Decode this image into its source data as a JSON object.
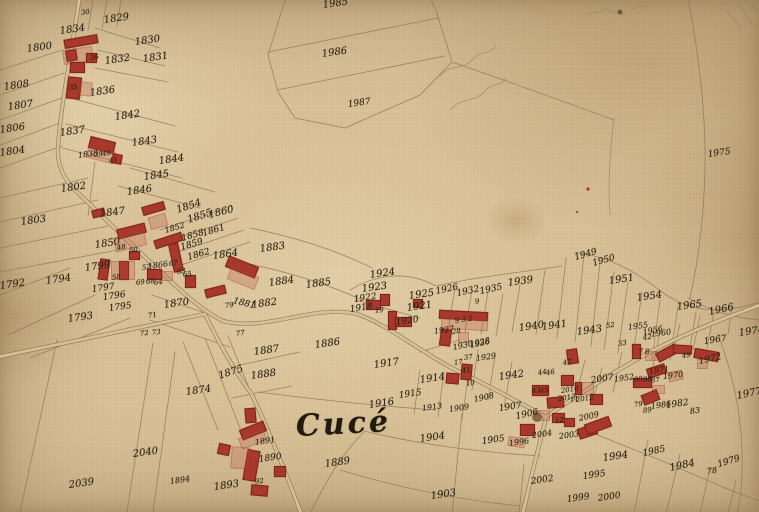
{
  "map": {
    "place_name": "Cucé",
    "colors": {
      "paper": "#d8c096",
      "ink": "#2f2517",
      "building_red": "#a8372c",
      "building_wash": "rgba(186,78,58,0.26)",
      "boundary_line": "#8a7456"
    },
    "labels_format": "text, x, y, fontSizePx(optional, default 10), rotationDeg(optional, default -8)",
    "labels": [
      [
        "1834",
        60,
        27
      ],
      [
        "1829",
        104,
        16
      ],
      [
        "30",
        81,
        10,
        7
      ],
      [
        "1800",
        27,
        45
      ],
      [
        "1830",
        135,
        38
      ],
      [
        "36",
        90,
        55,
        7
      ],
      [
        "1832",
        105,
        57
      ],
      [
        "1831",
        143,
        55
      ],
      [
        "1808",
        4,
        83
      ],
      [
        "35",
        69,
        85,
        7
      ],
      [
        "1836",
        90,
        89
      ],
      [
        "1807",
        8,
        103
      ],
      [
        "1842",
        115,
        113
      ],
      [
        "1806",
        0,
        126
      ],
      [
        "1837",
        60,
        129
      ],
      [
        "1843",
        132,
        139
      ],
      [
        "1804",
        0,
        149
      ],
      [
        "1838",
        78,
        152,
        8
      ],
      [
        "39",
        94,
        152,
        7
      ],
      [
        "40",
        102,
        151,
        7
      ],
      [
        "41",
        109,
        158,
        7
      ],
      [
        "1844",
        159,
        157
      ],
      [
        "1802",
        61,
        185
      ],
      [
        "1845",
        144,
        173
      ],
      [
        "1846",
        127,
        188
      ],
      [
        "1803",
        21,
        218
      ],
      [
        "1847",
        100,
        210
      ],
      [
        "1854",
        177,
        206,
        10,
        -18
      ],
      [
        "1855",
        188,
        216,
        10,
        -18
      ],
      [
        "1860",
        209,
        211,
        10,
        -14
      ],
      [
        "1852",
        165,
        227,
        8,
        -16
      ],
      [
        "1858",
        182,
        235,
        9,
        -16
      ],
      [
        "1861",
        203,
        230,
        9,
        -16
      ],
      [
        "1850",
        95,
        241
      ],
      [
        "1859",
        181,
        244,
        9,
        -16
      ],
      [
        "1862",
        188,
        254,
        9,
        -16
      ],
      [
        "1864",
        213,
        252
      ],
      [
        "48",
        117,
        245,
        7
      ],
      [
        "50",
        129,
        248,
        7
      ],
      [
        "52",
        142,
        265,
        7
      ],
      [
        "1866",
        148,
        263,
        8
      ],
      [
        "67",
        169,
        261,
        7
      ],
      [
        "63",
        177,
        269,
        7
      ],
      [
        "65",
        183,
        272,
        7
      ],
      [
        "58",
        112,
        275,
        7
      ],
      [
        "69",
        136,
        280,
        7
      ],
      [
        "68",
        146,
        279,
        7
      ],
      [
        "64",
        154,
        280,
        7
      ],
      [
        "1799",
        85,
        264
      ],
      [
        "1792",
        0,
        282
      ],
      [
        "1794",
        46,
        277
      ],
      [
        "1797",
        92,
        286,
        9
      ],
      [
        "1796",
        103,
        294,
        9
      ],
      [
        "1795",
        109,
        305,
        9
      ],
      [
        "1793",
        68,
        315
      ],
      [
        "1870",
        164,
        301
      ],
      [
        "79",
        225,
        303,
        7
      ],
      [
        "1881",
        233,
        297,
        9,
        14
      ],
      [
        "71",
        148,
        313,
        7
      ],
      [
        "72",
        140,
        331,
        7
      ],
      [
        "73",
        152,
        330,
        7
      ],
      [
        "77",
        236,
        331,
        7
      ],
      [
        "1985",
        323,
        1
      ],
      [
        "1986",
        322,
        50
      ],
      [
        "1987",
        348,
        101,
        9
      ],
      [
        "1975",
        708,
        151,
        9
      ],
      [
        "1883",
        260,
        245
      ],
      [
        "1884",
        269,
        279
      ],
      [
        "1885",
        306,
        281
      ],
      [
        "1882",
        252,
        301
      ],
      [
        "1924",
        370,
        271
      ],
      [
        "1923",
        362,
        285
      ],
      [
        "1922",
        354,
        296,
        9
      ],
      [
        "1925",
        409,
        292
      ],
      [
        "1918",
        350,
        306,
        9
      ],
      [
        "19",
        375,
        308,
        7
      ],
      [
        "1921",
        407,
        304
      ],
      [
        "1920",
        396,
        319,
        9
      ],
      [
        "1926",
        436,
        288,
        9,
        -12
      ],
      [
        "1932",
        457,
        290,
        9,
        -12
      ],
      [
        "9",
        475,
        299,
        7
      ],
      [
        "1935",
        480,
        288,
        9,
        -12
      ],
      [
        "9 3 2",
        455,
        318,
        7
      ],
      [
        "1927",
        434,
        328,
        8
      ],
      [
        "28",
        452,
        329,
        7
      ],
      [
        "1930",
        453,
        344,
        8,
        -12
      ],
      [
        "1936",
        470,
        342,
        8,
        -12
      ],
      [
        "37",
        464,
        355,
        7
      ],
      [
        "1929",
        476,
        355,
        8
      ],
      [
        "17",
        454,
        360,
        7
      ],
      [
        "41",
        462,
        368,
        7
      ],
      [
        "10",
        466,
        381,
        7
      ],
      [
        "1939",
        508,
        279
      ],
      [
        "1949",
        575,
        254,
        9,
        -16
      ],
      [
        "1950",
        593,
        260,
        9,
        -16
      ],
      [
        "1951",
        609,
        277
      ],
      [
        "1954",
        637,
        294
      ],
      [
        "1965",
        677,
        303
      ],
      [
        "1966",
        709,
        308,
        10,
        -12
      ],
      [
        "1940",
        519,
        324
      ],
      [
        "1941",
        542,
        323
      ],
      [
        "1943",
        577,
        328
      ],
      [
        "52",
        606,
        323,
        7
      ],
      [
        "33",
        618,
        341,
        7
      ],
      [
        "1955",
        628,
        324,
        8
      ],
      [
        "1956",
        643,
        329,
        8,
        -12
      ],
      [
        "42",
        643,
        335,
        7
      ],
      [
        "1960",
        651,
        331,
        8
      ],
      [
        "1974",
        739,
        329
      ],
      [
        "1977",
        737,
        392,
        10,
        -12
      ],
      [
        "1967",
        704,
        338,
        9
      ],
      [
        "1972",
        699,
        358,
        9,
        -12
      ],
      [
        "1971",
        649,
        368,
        8
      ],
      [
        "1970",
        663,
        373,
        8,
        -6
      ],
      [
        "7",
        639,
        349,
        7
      ],
      [
        "8",
        645,
        349,
        7
      ],
      [
        "49",
        682,
        353,
        7
      ],
      [
        "1952",
        614,
        376,
        8
      ],
      [
        "90",
        634,
        377,
        7
      ],
      [
        "88",
        643,
        377,
        7
      ],
      [
        "87",
        651,
        378,
        7
      ],
      [
        "79",
        634,
        402,
        7
      ],
      [
        "89",
        643,
        408,
        7
      ],
      [
        "1986",
        651,
        403,
        8
      ],
      [
        "1982",
        666,
        402,
        9
      ],
      [
        "83",
        690,
        408,
        8
      ],
      [
        "78",
        707,
        468,
        8
      ],
      [
        "1979",
        718,
        461,
        9,
        -16
      ],
      [
        "1984",
        670,
        464,
        10,
        -12
      ],
      [
        "1985",
        643,
        450,
        9,
        -12
      ],
      [
        "1942",
        499,
        373
      ],
      [
        "44",
        538,
        370,
        7
      ],
      [
        "46",
        546,
        370,
        7
      ],
      [
        "47",
        563,
        360,
        7
      ],
      [
        "43",
        532,
        388,
        7
      ],
      [
        "45",
        540,
        388,
        7
      ],
      [
        "2010",
        561,
        388,
        7
      ],
      [
        "2013",
        558,
        396,
        7
      ],
      [
        "11",
        570,
        397,
        7
      ],
      [
        "2012",
        576,
        397,
        7
      ],
      [
        "2007",
        591,
        377,
        9
      ],
      [
        "2009",
        579,
        415,
        8,
        -12
      ],
      [
        "1907",
        499,
        405,
        9
      ],
      [
        "1906",
        516,
        413,
        9,
        -12
      ],
      [
        "12",
        555,
        418,
        7
      ],
      [
        "2004",
        532,
        432,
        8
      ],
      [
        "2003",
        559,
        433,
        8
      ],
      [
        "2002",
        531,
        478,
        9
      ],
      [
        "1996",
        509,
        440,
        8
      ],
      [
        "1917",
        374,
        361
      ],
      [
        "1914",
        420,
        376
      ],
      [
        "1915",
        399,
        392,
        9
      ],
      [
        "1916",
        369,
        401
      ],
      [
        "1913",
        422,
        405,
        8
      ],
      [
        "1909",
        449,
        406,
        8
      ],
      [
        "1908",
        474,
        396,
        8,
        -12
      ],
      [
        "1904",
        420,
        435
      ],
      [
        "1905",
        482,
        438,
        9
      ],
      [
        "1903",
        431,
        492
      ],
      [
        "1886",
        315,
        341
      ],
      [
        "1887",
        254,
        348
      ],
      [
        "1888",
        251,
        372
      ],
      [
        "1889",
        325,
        460
      ],
      [
        "1891",
        255,
        439,
        8
      ],
      [
        "1890",
        259,
        456,
        9
      ],
      [
        "92",
        255,
        479,
        7
      ],
      [
        "1893",
        214,
        483
      ],
      [
        "1894",
        170,
        478,
        8
      ],
      [
        "2040",
        133,
        450
      ],
      [
        "2039",
        69,
        481
      ],
      [
        "1874",
        186,
        388
      ],
      [
        "1875",
        219,
        372,
        10,
        -18
      ],
      [
        "1928",
        470,
        341,
        8,
        -12
      ],
      [
        "1994",
        603,
        454
      ],
      [
        "1995",
        583,
        473,
        9
      ],
      [
        "1999",
        567,
        496,
        9
      ],
      [
        "2000",
        598,
        495,
        9
      ]
    ],
    "buildings_format": "x, y, w, h, rotationDeg, kind(0=solid red, 1=pink wash)",
    "buildings": [
      [
        64,
        37,
        32,
        7,
        -10,
        0
      ],
      [
        63,
        48,
        28,
        13,
        -8,
        1
      ],
      [
        66,
        50,
        9,
        9,
        -8,
        0
      ],
      [
        86,
        53,
        9,
        8,
        0,
        0
      ],
      [
        70,
        62,
        13,
        9,
        0,
        0
      ],
      [
        67,
        77,
        12,
        20,
        6,
        0
      ],
      [
        80,
        82,
        10,
        12,
        6,
        1
      ],
      [
        89,
        139,
        24,
        10,
        14,
        0
      ],
      [
        87,
        148,
        26,
        11,
        14,
        1
      ],
      [
        112,
        154,
        8,
        8,
        10,
        0
      ],
      [
        92,
        209,
        11,
        6,
        -14,
        0
      ],
      [
        142,
        204,
        21,
        7,
        -16,
        0
      ],
      [
        149,
        215,
        16,
        11,
        -16,
        1
      ],
      [
        117,
        226,
        27,
        8,
        -14,
        0
      ],
      [
        114,
        234,
        30,
        13,
        -14,
        1
      ],
      [
        154,
        236,
        27,
        7,
        -18,
        0
      ],
      [
        171,
        243,
        8,
        27,
        -12,
        0
      ],
      [
        99,
        259,
        8,
        19,
        8,
        0
      ],
      [
        119,
        261,
        8,
        17,
        0,
        0
      ],
      [
        111,
        261,
        22,
        17,
        0,
        1
      ],
      [
        129,
        251,
        9,
        7,
        0,
        0
      ],
      [
        147,
        269,
        13,
        9,
        0,
        0
      ],
      [
        162,
        271,
        9,
        8,
        0,
        1
      ],
      [
        185,
        275,
        9,
        11,
        0,
        0
      ],
      [
        205,
        287,
        19,
        7,
        -14,
        0
      ],
      [
        226,
        261,
        30,
        10,
        22,
        0
      ],
      [
        228,
        271,
        28,
        12,
        22,
        1
      ],
      [
        240,
        425,
        24,
        9,
        -22,
        0
      ],
      [
        239,
        433,
        25,
        10,
        -22,
        1
      ],
      [
        245,
        408,
        9,
        13,
        -5,
        0
      ],
      [
        218,
        444,
        10,
        9,
        12,
        0
      ],
      [
        245,
        450,
        11,
        29,
        10,
        0
      ],
      [
        231,
        447,
        17,
        20,
        5,
        1
      ],
      [
        274,
        466,
        10,
        9,
        0,
        0
      ],
      [
        251,
        485,
        15,
        9,
        5,
        0
      ],
      [
        366,
        300,
        13,
        8,
        0,
        0
      ],
      [
        380,
        294,
        8,
        10,
        0,
        0
      ],
      [
        388,
        311,
        7,
        17,
        0,
        0
      ],
      [
        395,
        317,
        15,
        8,
        0,
        0
      ],
      [
        413,
        299,
        8,
        7,
        0,
        0
      ],
      [
        439,
        311,
        47,
        7,
        3,
        0
      ],
      [
        441,
        318,
        45,
        10,
        3,
        1
      ],
      [
        440,
        329,
        9,
        15,
        8,
        0
      ],
      [
        458,
        332,
        9,
        9,
        0,
        1
      ],
      [
        461,
        364,
        9,
        14,
        5,
        0
      ],
      [
        446,
        373,
        11,
        9,
        5,
        0
      ],
      [
        567,
        349,
        9,
        13,
        -8,
        0
      ],
      [
        532,
        385,
        15,
        9,
        0,
        0
      ],
      [
        561,
        375,
        11,
        9,
        0,
        0
      ],
      [
        575,
        382,
        17,
        11,
        0,
        1
      ],
      [
        575,
        382,
        5,
        11,
        0,
        0
      ],
      [
        590,
        394,
        11,
        9,
        0,
        0
      ],
      [
        547,
        397,
        15,
        9,
        -5,
        0
      ],
      [
        535,
        410,
        13,
        9,
        0,
        1
      ],
      [
        552,
        413,
        11,
        8,
        0,
        0
      ],
      [
        564,
        418,
        9,
        7,
        0,
        0
      ],
      [
        520,
        424,
        13,
        10,
        0,
        0
      ],
      [
        578,
        426,
        17,
        9,
        -18,
        0
      ],
      [
        508,
        437,
        15,
        8,
        8,
        1
      ],
      [
        585,
        420,
        24,
        9,
        -20,
        0
      ],
      [
        632,
        344,
        7,
        13,
        0,
        0
      ],
      [
        645,
        351,
        11,
        8,
        0,
        1
      ],
      [
        656,
        348,
        20,
        8,
        -28,
        0
      ],
      [
        673,
        345,
        17,
        7,
        4,
        0
      ],
      [
        694,
        350,
        23,
        8,
        10,
        0
      ],
      [
        647,
        366,
        17,
        8,
        -18,
        0
      ],
      [
        668,
        371,
        13,
        8,
        -12,
        1
      ],
      [
        633,
        378,
        17,
        8,
        0,
        0
      ],
      [
        652,
        385,
        11,
        7,
        0,
        1
      ],
      [
        642,
        392,
        15,
        9,
        -22,
        0
      ],
      [
        697,
        359,
        9,
        8,
        0,
        1
      ]
    ]
  }
}
